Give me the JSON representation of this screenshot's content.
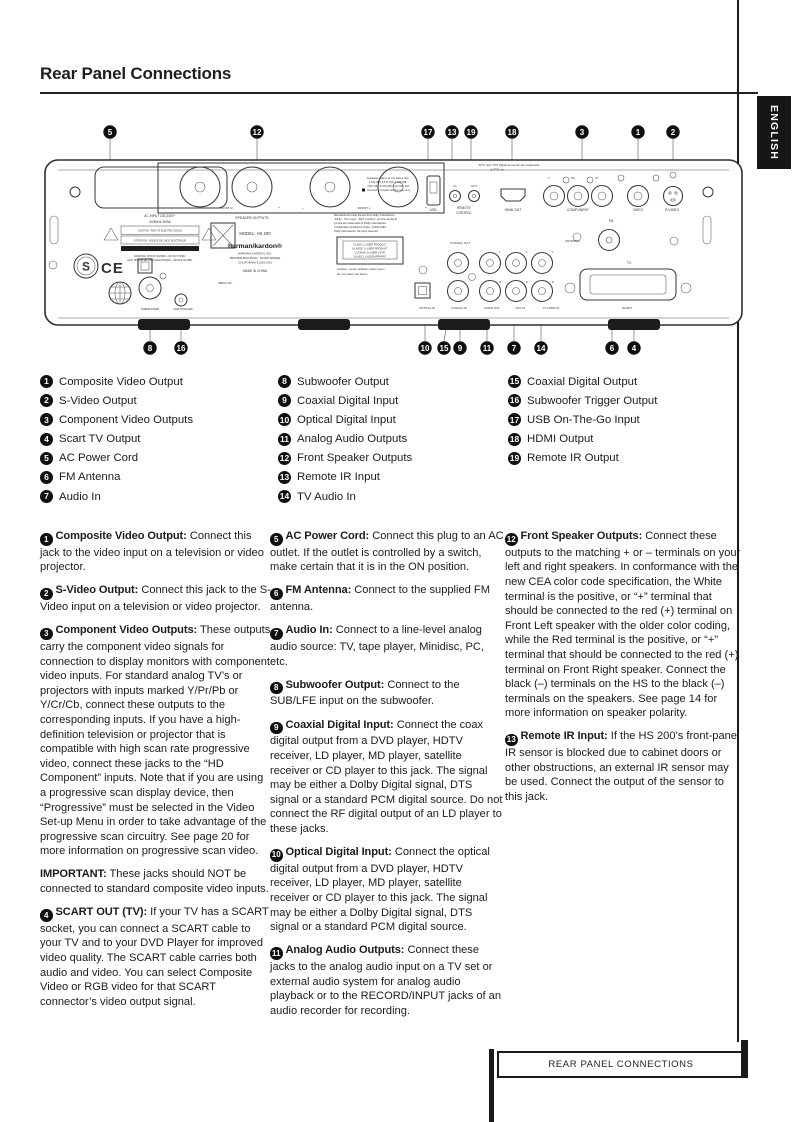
{
  "page": {
    "title": "Rear Panel Connections",
    "language_tab": "ENGLISH",
    "footer": "REAR PANEL CONNECTIONS"
  },
  "legend": {
    "col1": [
      {
        "n": "1",
        "label": "Composite Video Output"
      },
      {
        "n": "2",
        "label": "S-Video Output"
      },
      {
        "n": "3",
        "label": "Component Video Outputs"
      },
      {
        "n": "4",
        "label": "Scart TV Output"
      },
      {
        "n": "5",
        "label": "AC Power Cord"
      },
      {
        "n": "6",
        "label": "FM Antenna"
      },
      {
        "n": "7",
        "label": "Audio In"
      }
    ],
    "col2": [
      {
        "n": "8",
        "label": "Subwoofer Output"
      },
      {
        "n": "9",
        "label": "Coaxial Digital Input"
      },
      {
        "n": "10",
        "label": "Optical Digital Input"
      },
      {
        "n": "11",
        "label": "Analog Audio Outputs"
      },
      {
        "n": "12",
        "label": "Front Speaker Outputs"
      },
      {
        "n": "13",
        "label": "Remote IR Input"
      },
      {
        "n": "14",
        "label": "TV Audio In"
      }
    ],
    "col3": [
      {
        "n": "15",
        "label": "Coaxial Digital Output"
      },
      {
        "n": "16",
        "label": "Subwoofer Trigger Output"
      },
      {
        "n": "17",
        "label": "USB On-The-Go Input"
      },
      {
        "n": "18",
        "label": "HDMI Output"
      },
      {
        "n": "19",
        "label": "Remote IR Output"
      }
    ]
  },
  "sections": {
    "col1": [
      {
        "n": "1",
        "title": "Composite Video Output:",
        "body": "Connect this jack to the video input on a television or video projector."
      },
      {
        "n": "2",
        "title": "S-Video Output:",
        "body": "Connect this jack to the S-Video input on a television or video projector."
      },
      {
        "n": "3",
        "title": "Component Video Outputs:",
        "body": "These outputs carry the component video signals for connection to display monitors with component video inputs. For standard analog TV’s or projectors with inputs marked Y/Pr/Pb or Y/Cr/Cb, connect these outputs to the corresponding inputs. If you have a high-definition television or projector that is compatible with high scan rate progressive video, connect these jacks to the “HD Component” inputs. Note that if you are using a progressive scan display device, then “Progressive” must be selected in the Video Set-up Menu in order to take advantage of the progressive scan circuitry. See page 20 for more information on progressive scan video."
      },
      {
        "n": "",
        "title": "IMPORTANT:",
        "body": "These jacks should NOT be connected to standard composite video inputs."
      },
      {
        "n": "4",
        "title": "SCART OUT (TV):",
        "body": "If your TV has a SCART socket, you can connect a SCART cable to your TV and to your DVD Player for improved video quality. The SCART cable carries both audio and video. You can select Composite Video or RGB video for that SCART connector’s video output signal."
      }
    ],
    "col2": [
      {
        "n": "5",
        "title": "AC Power Cord:",
        "body": "Connect this plug to an AC outlet. If the outlet is controlled by a switch, make certain that it is in the ON position."
      },
      {
        "n": "6",
        "title": "FM Antenna:",
        "body": "Connect to the supplied FM antenna."
      },
      {
        "n": "7",
        "title": "Audio In:",
        "body": "Connect to a line-level analog audio source: TV, tape player, Minidisc, PC, etc."
      },
      {
        "n": "8",
        "title": "Subwoofer Output:",
        "body": "Connect to the SUB/LFE input on the subwoofer."
      },
      {
        "n": "9",
        "title": "Coaxial Digital Input:",
        "body": "Connect the coax digital output from a DVD player, HDTV receiver, LD player, MD player, satellite receiver or CD player to this jack. The signal may be either a Dolby Digital signal, DTS signal or a standard PCM digital source. Do not connect the RF digital output of an LD player to these jacks."
      },
      {
        "n": "10",
        "title": "Optical Digital Input:",
        "body": "Connect the optical digital output from a DVD player, HDTV receiver, LD player, MD player, satellite receiver or CD player to this jack. The signal may be either a Dolby Digital signal, DTS signal or a standard PCM digital source."
      },
      {
        "n": "11",
        "title": "Analog Audio Outputs:",
        "body": "Connect these jacks to the analog audio input on a TV set or external audio system for analog audio playback or to the RECORD/INPUT jacks of an audio recorder for recording."
      }
    ],
    "col3": [
      {
        "n": "12",
        "title": "Front Speaker Outputs:",
        "body": "Connect these outputs to the matching + or – terminals on your left and right speakers. In conformance with the new CEA color code specification, the White terminal is the positive, or “+” terminal that should be connected to the red (+) terminal on Front Left speaker with the older color coding, while the Red terminal is the positive, or “+” terminal that should be connected to the red (+) terminal on Front Right speaker. Connect the black (–) terminals on the HS to the black (–) terminals on the speakers. See page 14 for more information on speaker polarity."
      },
      {
        "n": "13",
        "title": "Remote IR Input:",
        "body": "If the HS 200’s front-panel IR sensor is blocked due to cabinet doors or other obstructions, an external IR sensor may be used. Connect the output of the sensor to this jack."
      }
    ]
  },
  "diagram": {
    "callouts_top": [
      {
        "n": "5"
      },
      {
        "n": "12"
      },
      {
        "n": "17"
      },
      {
        "n": "13"
      },
      {
        "n": "19"
      },
      {
        "n": "18"
      },
      {
        "n": "3"
      },
      {
        "n": "1"
      },
      {
        "n": "2"
      }
    ],
    "callouts_bottom": [
      {
        "n": "8"
      },
      {
        "n": "16"
      },
      {
        "n": "10"
      },
      {
        "n": "15"
      },
      {
        "n": "9"
      },
      {
        "n": "11"
      },
      {
        "n": "7"
      },
      {
        "n": "14"
      },
      {
        "n": "6"
      },
      {
        "n": "4"
      }
    ],
    "labels": {
      "speaker_outputs": "SPEAKER OUTPUTS",
      "front_r": "FRONT R",
      "front_l": "FRONT L",
      "minus": "–",
      "plus": "+",
      "ac_line1": "AC  INPUT  100-240V~",
      "ac_line2": "50/60Hz  300W",
      "caution_box": "CAUTION : RISK OF ELECTRIC SHOCK",
      "attention_box": "ATTENTION : RISQUE DE CHOC ELECTRIQUE",
      "warn1": "WARNING: SHOCK HAZARD – DO NOT OPEN.",
      "warn2": "AVIS: RISQUE DE CHOC ELECTRIQUE – NE PAS OUVRIR.",
      "s_mark": "S",
      "ce_mark": "CE",
      "model": "MODEL: HS 200",
      "brand": "harman/kardon®",
      "company": "HARMAN KARDON, INC.",
      "address": "8500 BALBOA BLVD., NORTHRIDGE",
      "address2": "CALIFORNIA 91329,USA",
      "made_in": "MADE IN CHINA",
      "serial": "SERIAL NO.",
      "usb": "USB",
      "in": "IN",
      "out": "OUT",
      "remote": "REMOTE",
      "control": "CONTROL",
      "hdmi_out": "HDMI OUT",
      "comp_y": "Y",
      "comp_pb": "Pb",
      "comp_pr": "Pr",
      "component": "COMPONENT",
      "video": "VIDEO",
      "s_video": "S-VIDEO",
      "fm": "FM",
      "antenna": "ANTENNA",
      "tv": "TV",
      "scart": "SCART",
      "coaxial_out": "COAXIAL OUT",
      "l": "L",
      "r": "R",
      "optical_in": "OPTICAL IN",
      "coaxial_in": "COAXIAL IN",
      "audio_out": "AUDIO OUT",
      "aux_in": "AUX IN",
      "tv_audio_in": "TV AUDIO IN",
      "subwoofer": "SUBWOOFER",
      "sub_trigger": "SUB TRIGGER"
    },
    "patent": [
      "Apparatus Claims of U.S.Patent Nos.",
      "4,631,603; 4,577,216; 4,819,098;",
      "4,907,093; 5,315,448 and 6,516,132",
      "licensed for limited viewing uses only."
    ],
    "dts": [
      "“DTS” and “DTS Digital Surround” are trademarks",
      "of DTS, Inc."
    ],
    "dolby": [
      "Manufactured under license from Dolby Laboratories.",
      "“Dolby”, “Pro Logic”, “MLP Lossless”, and the double-D",
      "symbol are trademarks of Dolby Laboratories.",
      "Confidential unpublished works, ©1992-1999",
      "Dolby Laboratories. All rights reserved."
    ],
    "laser": [
      "CLASS 1 LASER PRODUCT",
      "KLASSE 1 LASER PRODUKT",
      "LUOKAN 1 LASER LAITE",
      "KLASS 1 LASER APPARAT"
    ],
    "laser_caution": [
      "Caution: Laser radiation when open.",
      "Do not stare into beam."
    ]
  }
}
